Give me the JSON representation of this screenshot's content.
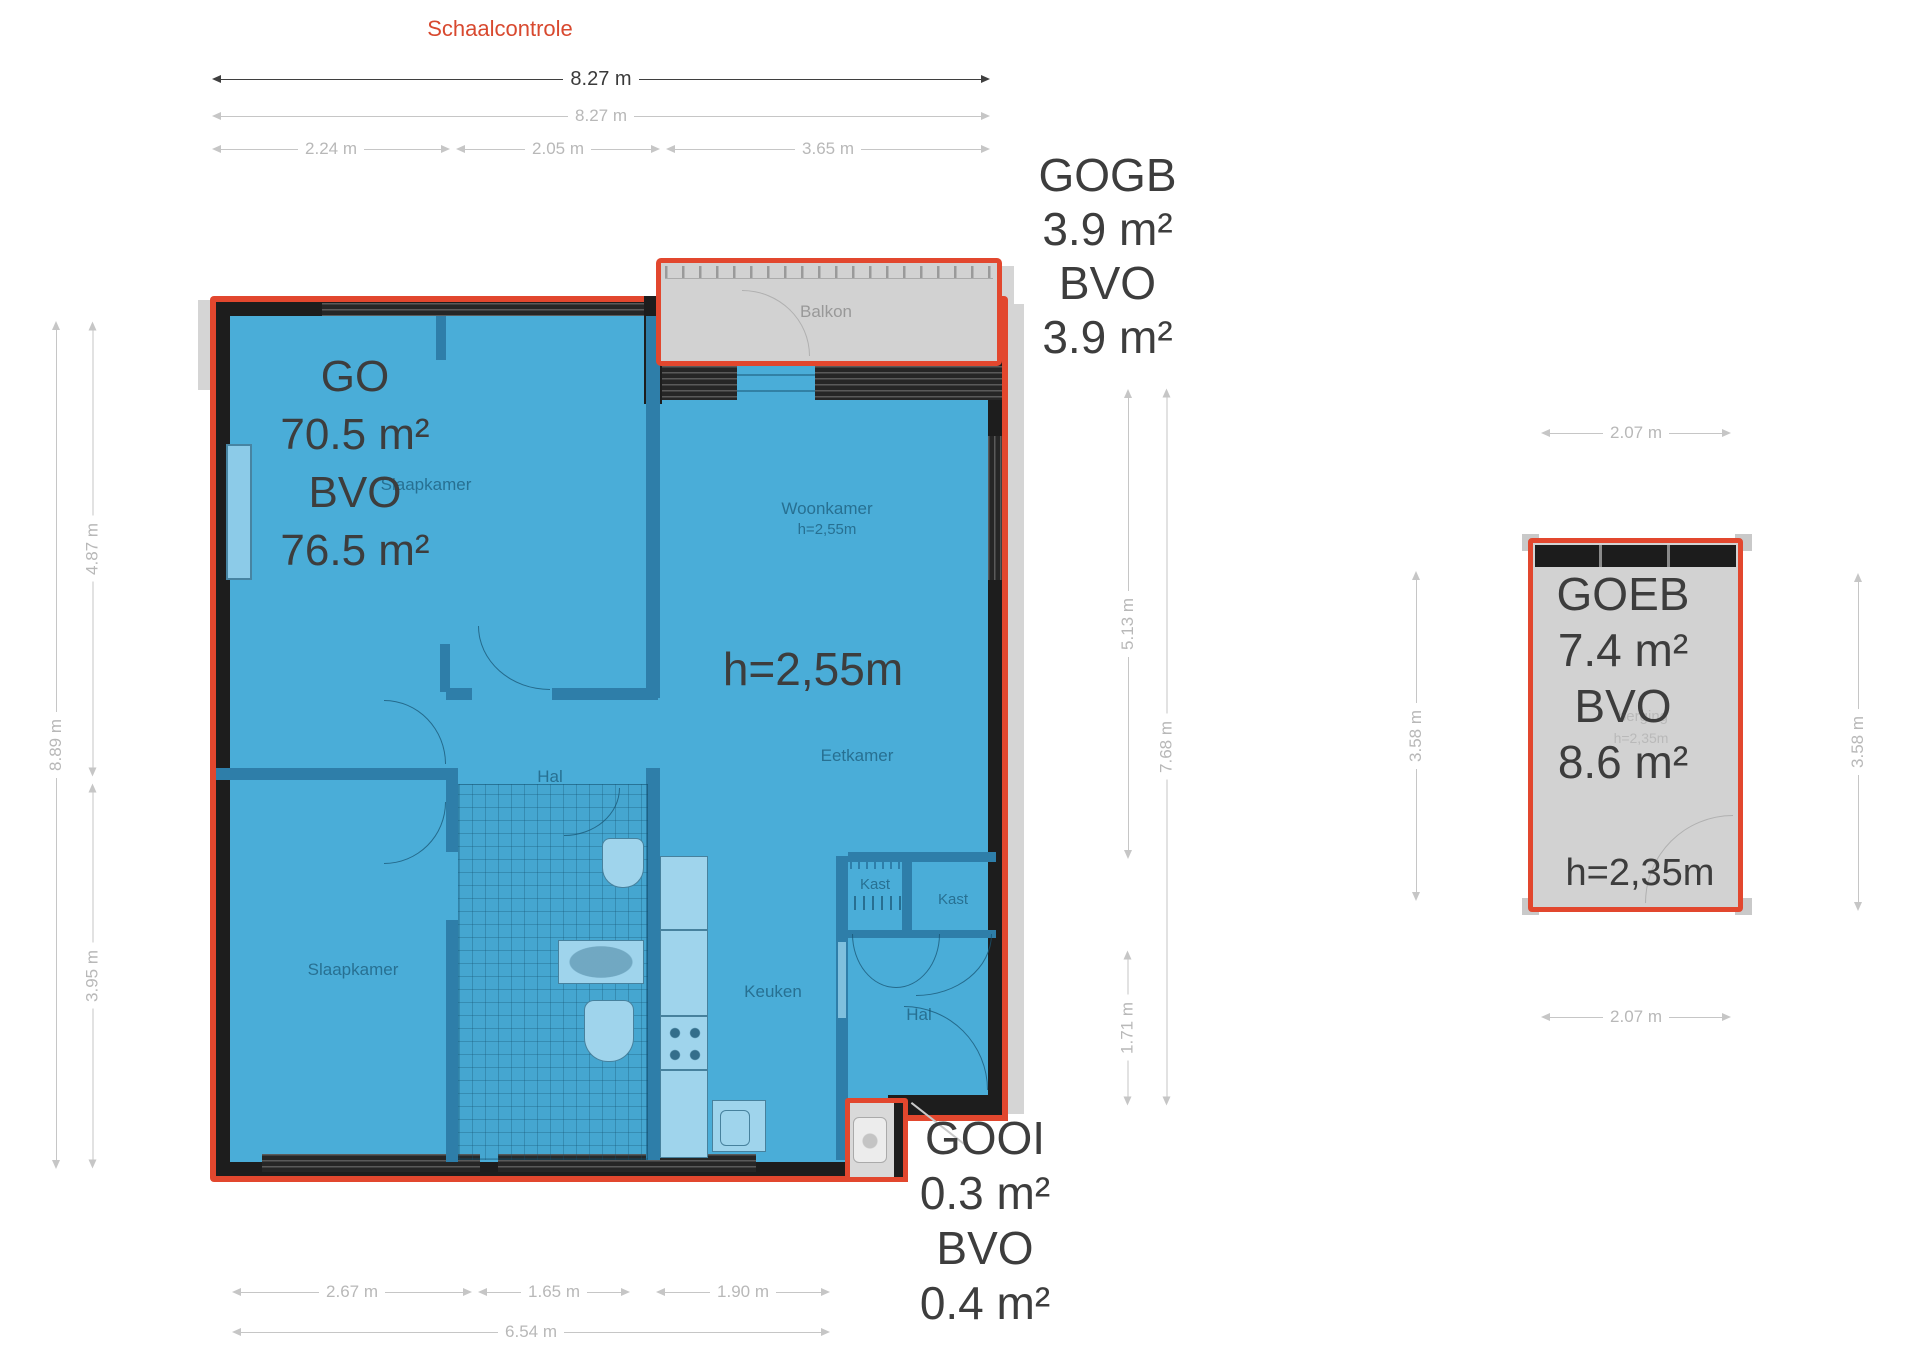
{
  "header": {
    "title": "Schaalcontrole"
  },
  "areas": {
    "go": {
      "code": "GO",
      "area": "70.5 m²",
      "bvo": "BVO",
      "bvo_area": "76.5 m²"
    },
    "gogb": {
      "code": "GOGB",
      "area": "3.9 m²",
      "bvo": "BVO",
      "bvo_area": "3.9 m²"
    },
    "gooi": {
      "code": "GOOI",
      "area": "0.3 m²",
      "bvo": "BVO",
      "bvo_area": "0.4 m²"
    },
    "goeb": {
      "code": "GOEB",
      "area": "7.4 m²",
      "bvo": "BVO",
      "bvo_area": "8.6 m²",
      "ceiling": "h=2,35m"
    }
  },
  "ceiling_note": "h=2,55m",
  "rooms": {
    "balkon": "Balkon",
    "slaapkamer_top": "Slaapkamer",
    "slaapkamer_bottom": "Slaapkamer",
    "woonkamer": "Woonkamer",
    "woonkamer_height": "h=2,55m",
    "eetkamer": "Eetkamer",
    "hal_top": "Hal",
    "hal_bottom": "Hal",
    "kast_left": "Kast",
    "kast_right": "Kast",
    "keuken": "Keuken",
    "berging": "berging",
    "berging_height": "h=2,35m"
  },
  "dims": {
    "top_total_bold": "8.27 m",
    "top_total": "8.27 m",
    "top_segments": [
      "2.24 m",
      "2.05 m",
      "3.65 m"
    ],
    "left_total": "8.89 m",
    "left_upper": "4.87 m",
    "left_lower": "3.95 m",
    "right_upper": "5.13 m",
    "right_total": "7.68 m",
    "right_lower": "1.71 m",
    "bottom_segments": [
      "2.67 m",
      "1.65 m",
      "1.90 m"
    ],
    "bottom_total": "6.54 m",
    "goeb_top": "2.07 m",
    "goeb_bottom": "2.07 m",
    "goeb_left": "3.58 m",
    "goeb_right": "3.58 m"
  },
  "colors": {
    "outline_red": "#e2472e",
    "floor_blue": "#4aadd8",
    "wall_black": "#1d1d1d",
    "balcony_gray": "#d2d2d2",
    "title_red": "#d8492f"
  }
}
